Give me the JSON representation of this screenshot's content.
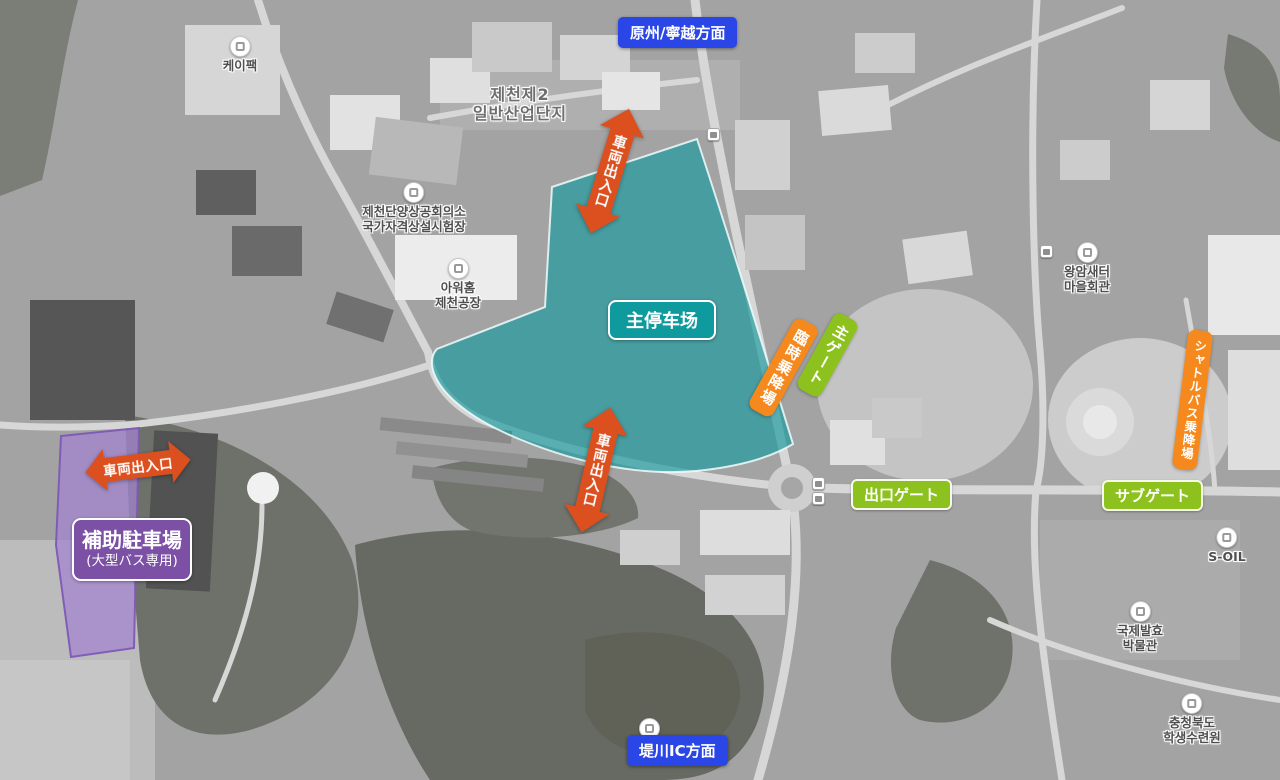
{
  "colors": {
    "blue": "#2a46e6",
    "teal": "#0f9b9e",
    "green": "#8dc21e",
    "orange": "#f5891d",
    "redorange": "#dc4f1e",
    "purple": "#7b50a5"
  },
  "badges": {
    "direction_top": "原州/寧越方面",
    "direction_bottom": "堤川IC方面",
    "main_parking": "主停车场",
    "aux_parking_line1": "補助駐車場",
    "aux_parking_line2": "(大型バス専用)",
    "main_gate": "主ゲート",
    "exit_gate": "出口ゲート",
    "sub_gate": "サブゲート",
    "temp_boarding": "臨時乗降場",
    "shuttle_boarding": "シャトルバス乗降場"
  },
  "arrows": [
    {
      "label": "車両出入口"
    },
    {
      "label": "車両出入口"
    },
    {
      "label": "車両出入口"
    }
  ],
  "pois": [
    {
      "line1": "케이팩",
      "line2": ""
    },
    {
      "line1": "제천제2",
      "line2": "일반산업단지"
    },
    {
      "line1": "제천단양상공회의소",
      "line2": "국가자격상설시험장"
    },
    {
      "line1": "아워홈",
      "line2": "제천공장"
    },
    {
      "line1": "왕암새터",
      "line2": "마을회관"
    },
    {
      "line1": "S-OIL",
      "line2": ""
    },
    {
      "line1": "국제발효",
      "line2": "박물관"
    },
    {
      "line1": "충청북도",
      "line2": "학생수련원"
    }
  ]
}
